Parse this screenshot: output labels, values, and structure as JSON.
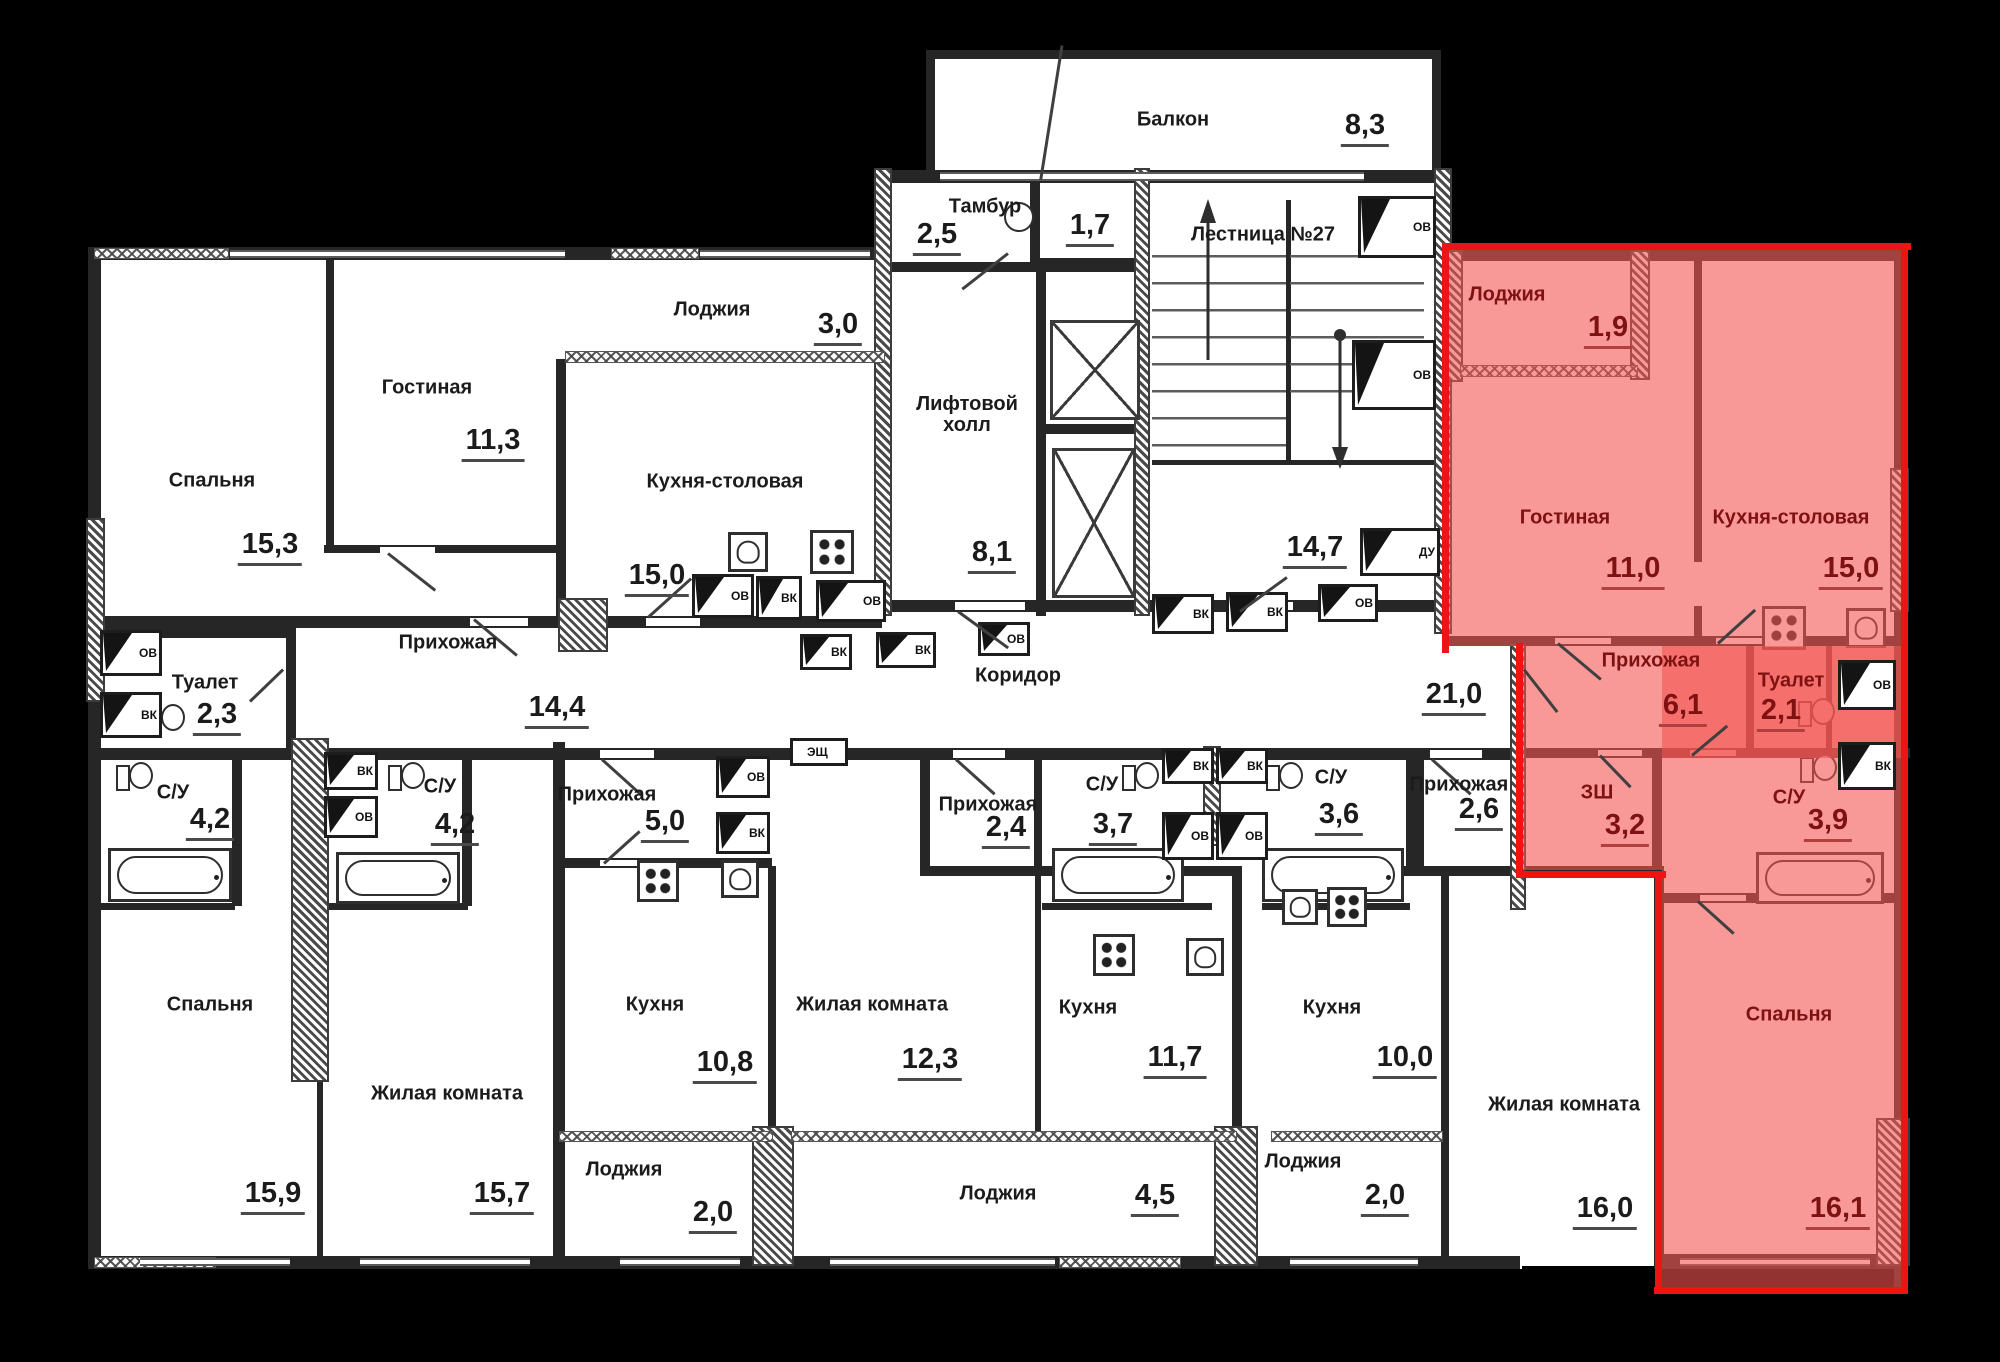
{
  "plan": {
    "rooms": [
      {
        "id": "bedroom-1",
        "label": "Спальня",
        "area": "15,3",
        "highlighted": false
      },
      {
        "id": "living-1",
        "label": "Гостиная",
        "area": "11,3",
        "highlighted": false
      },
      {
        "id": "loggia-1",
        "label": "Лоджия",
        "area": "3,0",
        "highlighted": false
      },
      {
        "id": "kitchen-dining-1",
        "label": "Кухня-столовая",
        "area": "15,0",
        "highlighted": false
      },
      {
        "id": "toilet-1",
        "label": "Туалет",
        "area": "2,3",
        "highlighted": false
      },
      {
        "id": "hall-1",
        "label": "Прихожая",
        "area": "14,4",
        "highlighted": false
      },
      {
        "id": "tambour",
        "label": "Тамбур",
        "area": "2,5",
        "highlighted": false
      },
      {
        "id": "wc-lobby",
        "label": "",
        "area": "1,7",
        "highlighted": false
      },
      {
        "id": "balcony",
        "label": "Балкон",
        "area": "8,3",
        "highlighted": false
      },
      {
        "id": "staircase",
        "label": "Лестница №27",
        "area": "14,7",
        "highlighted": false
      },
      {
        "id": "lift-hall",
        "label": "Лифтовой холл",
        "area": "8,1",
        "highlighted": false
      },
      {
        "id": "corridor",
        "label": "Коридор",
        "area": "21,0",
        "highlighted": false
      },
      {
        "id": "hl-loggia",
        "label": "Лоджия",
        "area": "1,9",
        "highlighted": true
      },
      {
        "id": "hl-living",
        "label": "Гостиная",
        "area": "11,0",
        "highlighted": true
      },
      {
        "id": "hl-kitchen-dining",
        "label": "Кухня-столовая",
        "area": "15,0",
        "highlighted": true
      },
      {
        "id": "hl-hall",
        "label": "Прихожая",
        "area": "6,1",
        "highlighted": true
      },
      {
        "id": "hl-toilet",
        "label": "Туалет",
        "area": "2,1",
        "highlighted": true
      },
      {
        "id": "hl-wardrobe",
        "label": "ЗШ",
        "area": "3,2",
        "highlighted": true
      },
      {
        "id": "hl-bath",
        "label": "С/У",
        "area": "3,9",
        "highlighted": true
      },
      {
        "id": "hl-bedroom",
        "label": "Спальня",
        "area": "16,1",
        "highlighted": true
      },
      {
        "id": "bath-1",
        "label": "С/У",
        "area": "4,2",
        "highlighted": false
      },
      {
        "id": "bath-2",
        "label": "С/У",
        "area": "4,2",
        "highlighted": false
      },
      {
        "id": "bedroom-2",
        "label": "Спальня",
        "area": "15,9",
        "highlighted": false
      },
      {
        "id": "living-2",
        "label": "Жилая комната",
        "area": "15,7",
        "highlighted": false
      },
      {
        "id": "hall-2",
        "label": "Прихожая",
        "area": "5,0",
        "highlighted": false
      },
      {
        "id": "kitchen-1",
        "label": "Кухня",
        "area": "10,8",
        "highlighted": false
      },
      {
        "id": "loggia-2",
        "label": "Лоджия",
        "area": "2,0",
        "highlighted": false
      },
      {
        "id": "living-3",
        "label": "Жилая комната",
        "area": "12,3",
        "highlighted": false
      },
      {
        "id": "hall-3",
        "label": "Прихожая",
        "area": "2,4",
        "highlighted": false
      },
      {
        "id": "bath-3",
        "label": "С/У",
        "area": "3,7",
        "highlighted": false
      },
      {
        "id": "kitchen-2",
        "label": "Кухня",
        "area": "11,7",
        "highlighted": false
      },
      {
        "id": "loggia-3",
        "label": "Лоджия",
        "area": "4,5",
        "highlighted": false
      },
      {
        "id": "bath-4",
        "label": "С/У",
        "area": "3,6",
        "highlighted": false
      },
      {
        "id": "kitchen-3",
        "label": "Кухня",
        "area": "10,0",
        "highlighted": false
      },
      {
        "id": "loggia-4",
        "label": "Лоджия",
        "area": "2,0",
        "highlighted": false
      },
      {
        "id": "hall-4",
        "label": "Прихожая",
        "area": "2,6",
        "highlighted": false
      },
      {
        "id": "living-4",
        "label": "Жилая комната",
        "area": "16,0",
        "highlighted": false
      }
    ],
    "shafts": [
      {
        "label": "ОВ"
      },
      {
        "label": "ВК"
      },
      {
        "label": "ОВ"
      },
      {
        "label": "ВК"
      },
      {
        "label": "ОВ"
      },
      {
        "label": "ОВ"
      },
      {
        "label": "ОВ"
      },
      {
        "label": "ДУ"
      },
      {
        "label": "ВК"
      },
      {
        "label": "ВК"
      },
      {
        "label": "ОВ"
      },
      {
        "label": "ВК"
      },
      {
        "label": "ВК"
      },
      {
        "label": "ОВ"
      },
      {
        "label": "ЭЩ"
      },
      {
        "label": "ОВ"
      },
      {
        "label": "ВК"
      },
      {
        "label": "ВК"
      },
      {
        "label": "ОВ"
      },
      {
        "label": "ВК"
      },
      {
        "label": "ВК"
      },
      {
        "label": "ОВ"
      },
      {
        "label": "ОВ"
      },
      {
        "label": "ОВ"
      },
      {
        "label": "ВК"
      }
    ],
    "colors": {
      "background": "#000000",
      "floor": "#ffffff",
      "wall": "#262626",
      "highlight_fill": "rgba(243,85,82,0.60)",
      "highlight_edge": "#ee1414",
      "highlight_text": "#7e1111",
      "text": "#1b1b1b"
    }
  }
}
